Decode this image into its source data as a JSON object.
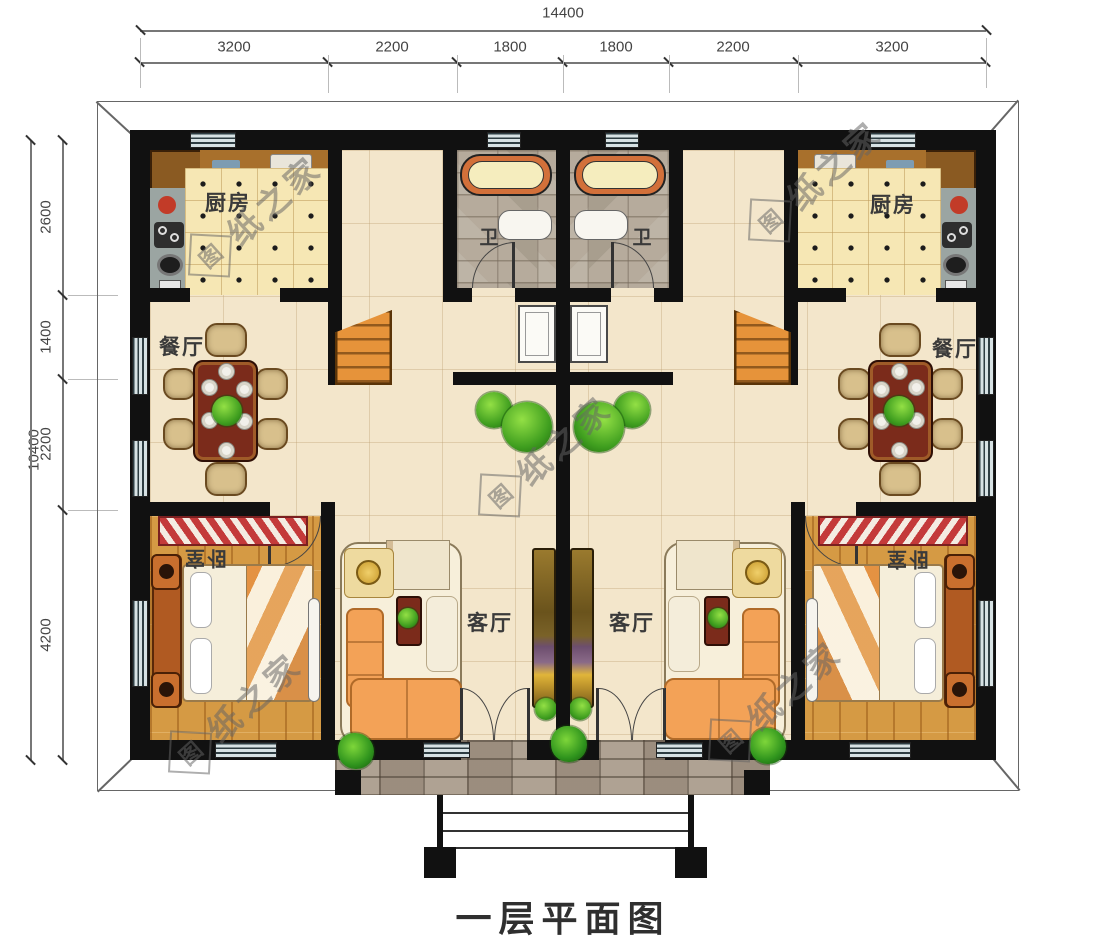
{
  "title": "一层平面图",
  "watermark": {
    "seal_char": "图",
    "text": "纸之家"
  },
  "dimensions": {
    "top": {
      "total": "14400",
      "segments": [
        "3200",
        "2200",
        "1800",
        "1800",
        "2200",
        "3200"
      ]
    },
    "left": {
      "total": "10400",
      "segments": [
        "2600",
        "1400",
        "2200",
        "4200"
      ]
    }
  },
  "rooms": {
    "kitchen_left": {
      "label": "厨房"
    },
    "kitchen_right": {
      "label": "厨房"
    },
    "bath_left": {
      "label": "卫"
    },
    "bath_right": {
      "label": "卫"
    },
    "dining_left": {
      "label": "餐厅"
    },
    "dining_right": {
      "label": "餐厅"
    },
    "living_left": {
      "label": "客厅"
    },
    "living_right": {
      "label": "客厅"
    },
    "bedroom_left": {
      "label": "卧室"
    },
    "bedroom_right": {
      "label": "卧室"
    }
  },
  "colors": {
    "wall": "#111111",
    "floor": "#f3e6cb",
    "kitchen_tile": "#f6e7b4",
    "bedroom_wood": "#d59a44",
    "bath_stone": "#b6ab9c",
    "stair": "#e6933a",
    "dining_table": "#7b2b1b",
    "plant_green": "#3f9e1f",
    "watermark_gray": "#696969"
  }
}
